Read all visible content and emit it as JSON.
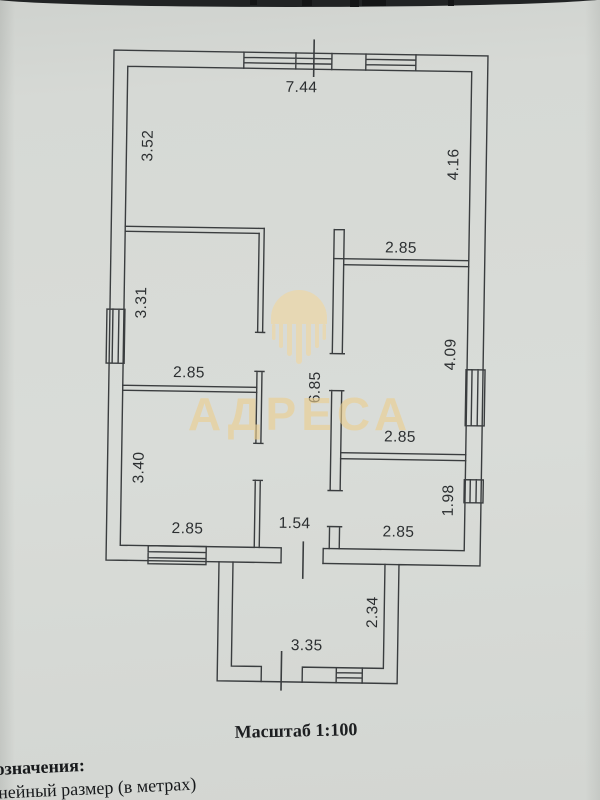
{
  "page": {
    "type_note": "scanned floor plan page",
    "scale_text": "Масштаб 1:100",
    "legend_heading_partial": "означения:",
    "legend_item_partial": "инейный размер (в метрах)"
  },
  "watermark": {
    "text": "АДРЕСА",
    "logo_icon": "building-emblem-icon",
    "color": "#eccf8e"
  },
  "floor_plan": {
    "scale": "1:100",
    "units": "meters",
    "dimensions": [
      {
        "value": "7.44",
        "where": "top-outer-width"
      },
      {
        "value": "3.52",
        "where": "big-room-left-height"
      },
      {
        "value": "4.16",
        "where": "big-room-right-height"
      },
      {
        "value": "2.85",
        "where": "right-middle-room-top-width"
      },
      {
        "value": "3.31",
        "where": "left-middle-room-height"
      },
      {
        "value": "2.85",
        "where": "left-middle-room-width"
      },
      {
        "value": "6.85",
        "where": "corridor-length"
      },
      {
        "value": "4.09",
        "where": "right-middle-room-height"
      },
      {
        "value": "3.40",
        "where": "left-bottom-room-height"
      },
      {
        "value": "2.85",
        "where": "right-middle-room-bottom-width"
      },
      {
        "value": "2.85",
        "where": "left-bottom-room-width"
      },
      {
        "value": "1.54",
        "where": "corridor-width"
      },
      {
        "value": "2.85",
        "where": "right-bottom-room-width"
      },
      {
        "value": "1.98",
        "where": "right-bottom-room-height"
      },
      {
        "value": "2.34",
        "where": "porch-height"
      },
      {
        "value": "3.35",
        "where": "porch-width"
      }
    ]
  },
  "colors": {
    "paper": "#d6d9d5",
    "line": "#3a3d3f",
    "dimension_text": "#2c2f31",
    "watermark_gold": "#eccf8e",
    "scan_edge": "#212324"
  }
}
